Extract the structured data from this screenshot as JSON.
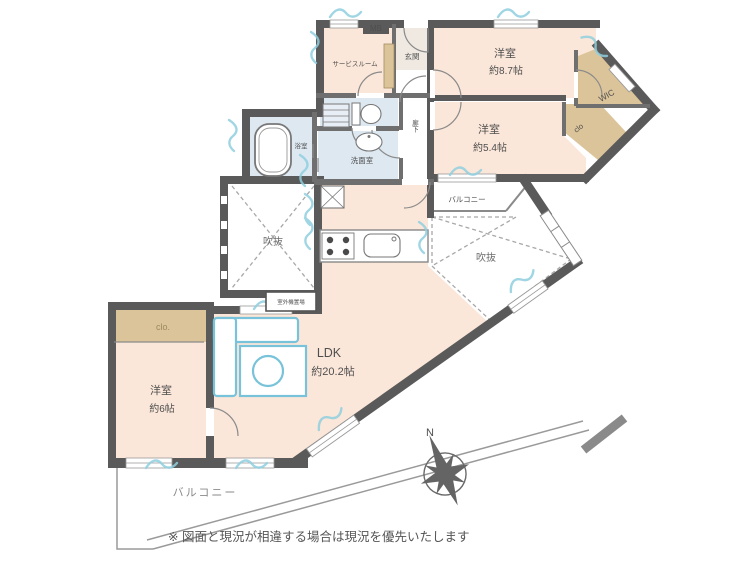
{
  "rooms": {
    "western87": {
      "name": "洋室",
      "size": "約8.7帖"
    },
    "western54": {
      "name": "洋室",
      "size": "約5.4帖"
    },
    "western6": {
      "name": "洋室",
      "size": "約6帖"
    },
    "ldk": {
      "name": "LDK",
      "size": "約20.2帖"
    },
    "service": {
      "name": "サービスルーム"
    },
    "entrance": {
      "name": "玄関"
    },
    "bath": {
      "name": "浴室"
    },
    "wash": {
      "name": "洗面室"
    },
    "corridor": {
      "name": "廊下"
    },
    "wic": {
      "name": "WIC"
    },
    "closet_ne": {
      "name": "clo"
    },
    "closet_w": {
      "name": "clo."
    },
    "void_left": {
      "name": "吹抜"
    },
    "void_right": {
      "name": "吹抜"
    },
    "balcony_small": {
      "name": "バルコニー"
    },
    "balcony_main": {
      "name": "バルコニー"
    },
    "meter_box": {
      "name": "MB"
    },
    "outdoor_unit": {
      "name": "室外機置場"
    }
  },
  "compass": {
    "north": "N"
  },
  "disclaimer": "※ 図面と現況が相違する場合は現況を優先いたします",
  "colors": {
    "room_fill": "#fbe7d9",
    "closet_fill": "#dcc49a",
    "wet_fill": "#dde8f1",
    "wall": "#5a5a5a",
    "accent": "#8fcfe0",
    "furniture": "#79c3da"
  }
}
